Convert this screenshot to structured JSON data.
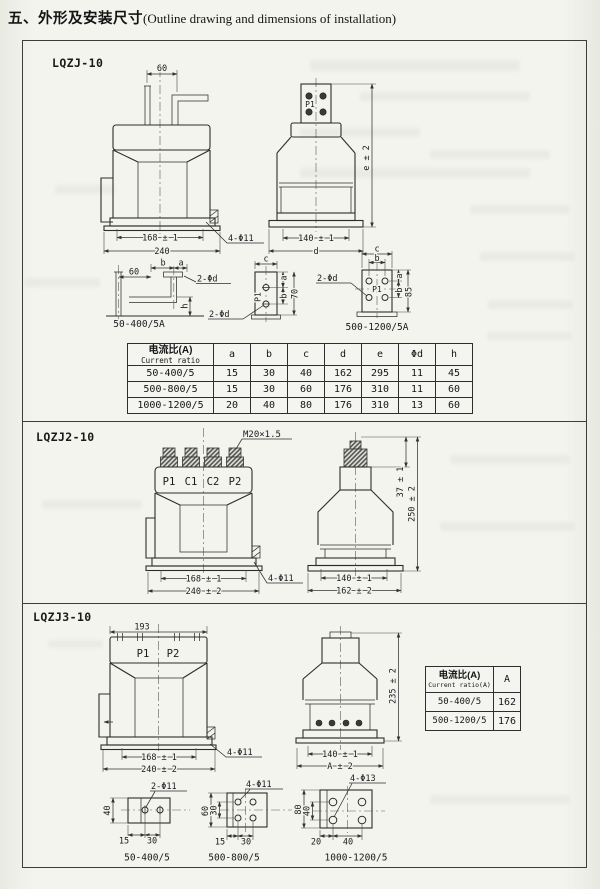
{
  "title": {
    "zh": "五、外形及安装尺寸",
    "en": "(Outline drawing and dimensions of installation)"
  },
  "s1": {
    "model": "LQZJ-10",
    "front": {
      "dim_top": "60",
      "dim_inner": "168 ± 1",
      "dim_outer": "240",
      "holes_label": "4-Φ11"
    },
    "side": {
      "terminal": "P1",
      "dim_inner": "140 ± 1",
      "dim_outer": "d",
      "dim_height": "e ± 2"
    },
    "dl": {
      "dim_60": "60",
      "dim_b": "b",
      "dim_a": "a",
      "dim_h": "h",
      "label_top": "2-Φd",
      "label_bottom": "2-Φd",
      "caption": "50-400/5A"
    },
    "plate": {
      "dim_c": "c",
      "dim_a": "a",
      "dim_b": "b",
      "dim_70": "70",
      "terminal": "P1"
    },
    "dr": {
      "label": "2-Φd",
      "dim_c": "c",
      "dim_b_top": "b",
      "dim_a": "a",
      "dim_b": "b",
      "dim_85": "85",
      "terminal": "P1",
      "caption": "500-1200/5A"
    },
    "table": {
      "header_zh": "电流比(A)",
      "header_en": "Current ratio",
      "cols": [
        "a",
        "b",
        "c",
        "d",
        "e",
        "Φd",
        "h"
      ],
      "rows": [
        {
          "ratio": "50-400/5",
          "v": [
            "15",
            "30",
            "40",
            "162",
            "295",
            "11",
            "45"
          ]
        },
        {
          "ratio": "500-800/5",
          "v": [
            "15",
            "30",
            "60",
            "176",
            "310",
            "11",
            "60"
          ]
        },
        {
          "ratio": "1000-1200/5",
          "v": [
            "20",
            "40",
            "80",
            "176",
            "310",
            "13",
            "60"
          ]
        }
      ]
    }
  },
  "s2": {
    "model": "LQZJ2-10",
    "front": {
      "thread": "M20×1.5",
      "terminals": [
        "P1",
        "C1",
        "C2",
        "P2"
      ],
      "dim_inner": "168 ± 1",
      "dim_outer": "240 ± 2",
      "holes_label": "4-Φ11"
    },
    "side": {
      "dim_stud": "37 ± 1",
      "dim_height": "250 ± 2",
      "dim_inner": "140 ± 1",
      "dim_outer": "162 ± 2"
    }
  },
  "s3": {
    "model": "LQZJ3-10",
    "front": {
      "dim_top": "193",
      "terminals": [
        "P1",
        "P2"
      ],
      "dim_inner": "168 ± 1",
      "dim_outer": "240 ± 2",
      "holes_label": "4-Φ11"
    },
    "side": {
      "dim_height": "235 ± 2",
      "dim_inner": "140 ± 1",
      "dim_outer": "A ± 2"
    },
    "table": {
      "header_zh": "电流比(A)",
      "header_en": "Current ratio(A)",
      "col_a": "A",
      "rows": [
        {
          "ratio": "50-400/5",
          "a": "162"
        },
        {
          "ratio": "500-1200/5",
          "a": "176"
        }
      ]
    },
    "da": {
      "label": "2-Φ11",
      "dim_40": "40",
      "dim_15": "15",
      "dim_30": "30",
      "caption": "50-400/5"
    },
    "db": {
      "label": "4-Φ11",
      "dim_60": "60",
      "dim_30v": "30",
      "dim_15": "15",
      "dim_30": "30",
      "caption": "500-800/5"
    },
    "dc": {
      "label": "4-Φ13",
      "dim_80": "80",
      "dim_40v": "40",
      "dim_20": "20",
      "dim_40": "40",
      "caption": "1000-1200/5"
    }
  }
}
